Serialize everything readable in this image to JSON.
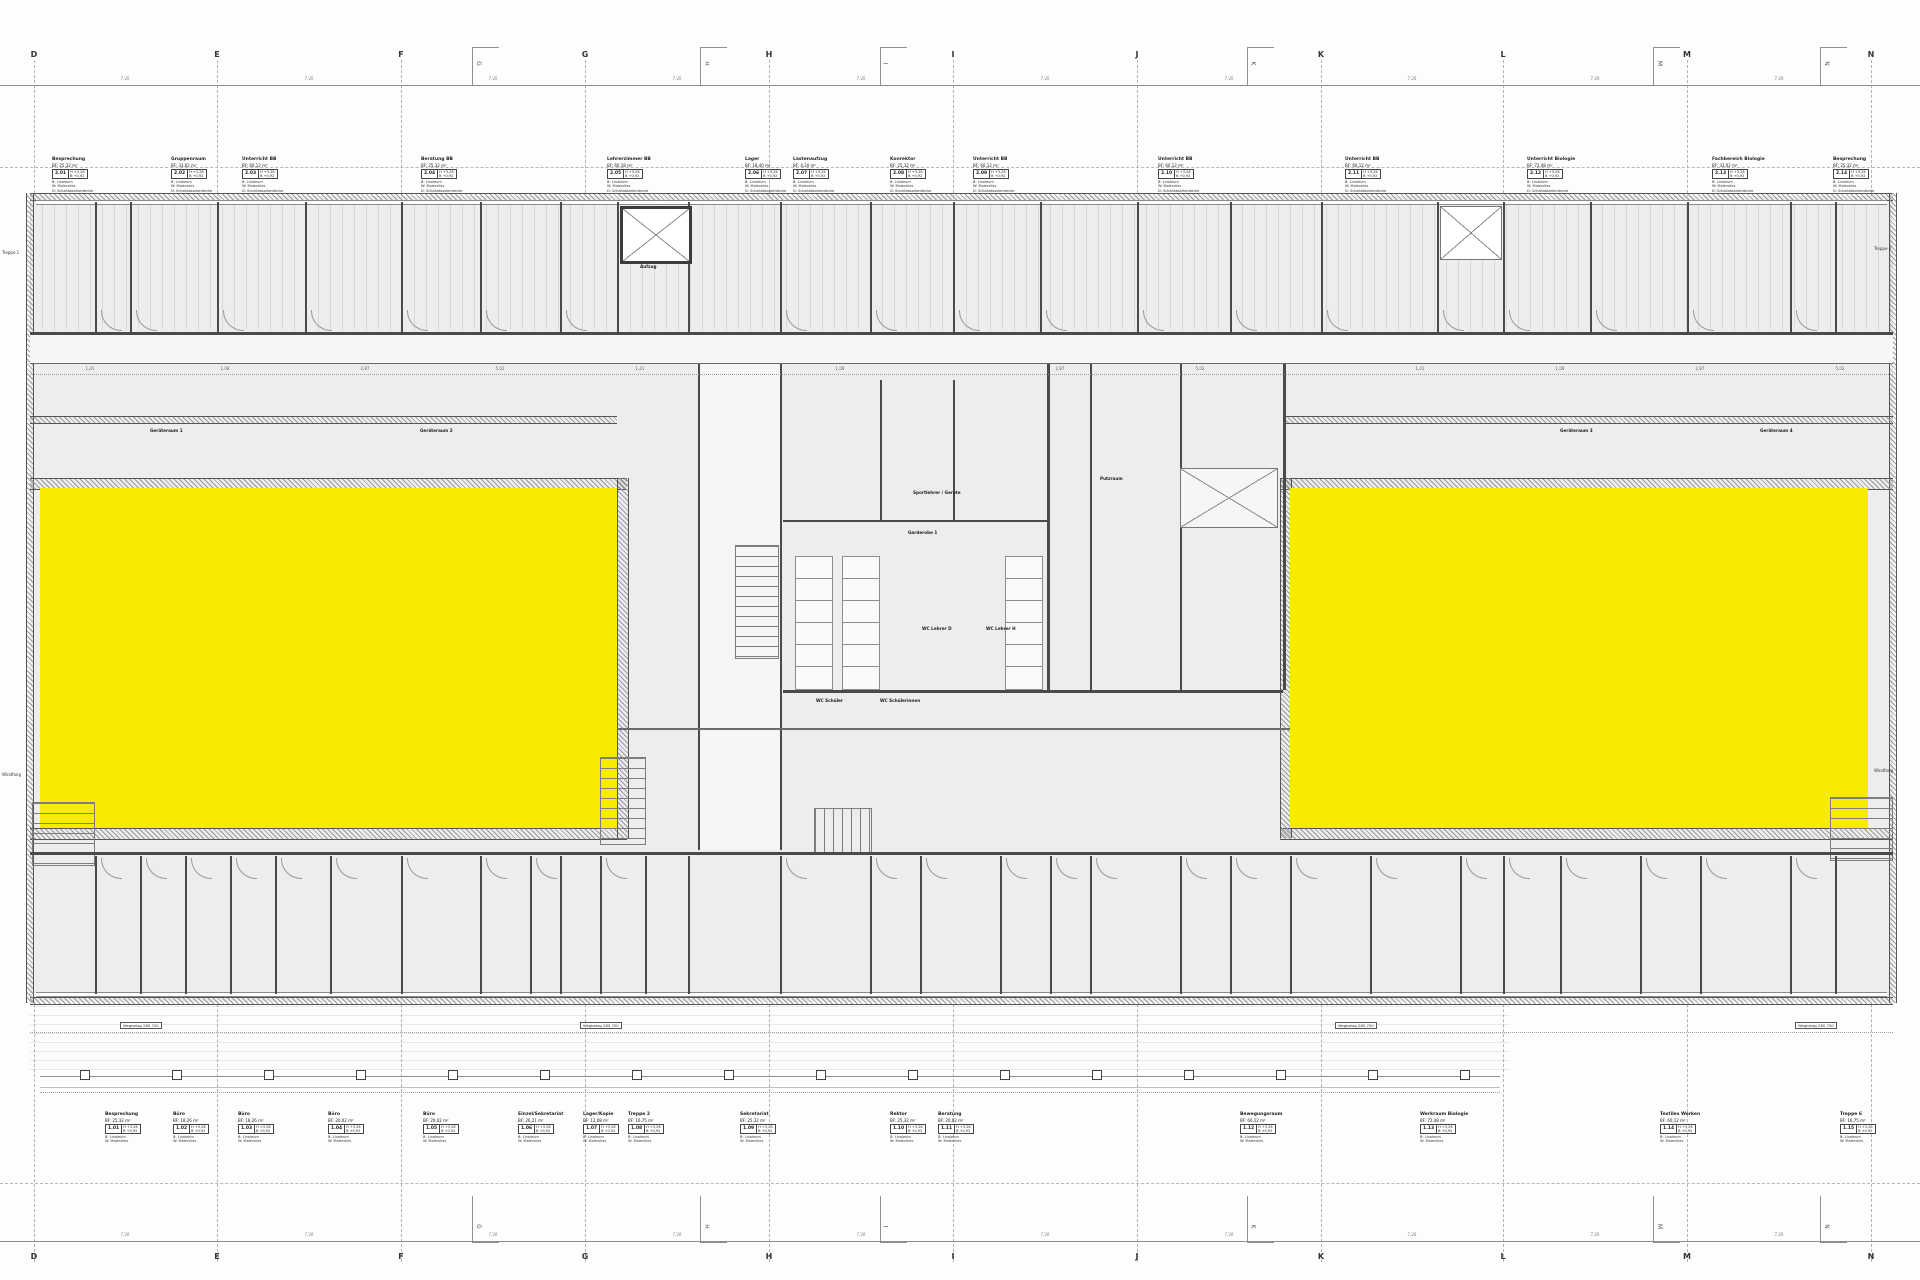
{
  "colors": {
    "highlight": "#F7EB00",
    "wall": "#4a4a4a",
    "grid_line": "#b3b3b3",
    "floor": "#ededed",
    "text": "#1a1a1a"
  },
  "grid": {
    "letters": [
      {
        "label": "D",
        "x": 34
      },
      {
        "label": "E",
        "x": 217
      },
      {
        "label": "F",
        "x": 401
      },
      {
        "label": "G",
        "x": 585
      },
      {
        "label": "H",
        "x": 769
      },
      {
        "label": "I",
        "x": 953
      },
      {
        "label": "J",
        "x": 1137
      },
      {
        "label": "K",
        "x": 1321
      },
      {
        "label": "L",
        "x": 1503
      },
      {
        "label": "M",
        "x": 1687
      },
      {
        "label": "N",
        "x": 1871
      }
    ]
  },
  "ruler": {
    "dims": [
      {
        "v": "7,20",
        "x": 125
      },
      {
        "v": "7,20",
        "x": 309
      },
      {
        "v": "7,20",
        "x": 493
      },
      {
        "v": "7,20",
        "x": 677
      },
      {
        "v": "7,20",
        "x": 861
      },
      {
        "v": "7,20",
        "x": 1045
      },
      {
        "v": "7,20",
        "x": 1229
      },
      {
        "v": "7,20",
        "x": 1412
      },
      {
        "v": "7,20",
        "x": 1595
      },
      {
        "v": "7,20",
        "x": 1779
      }
    ]
  },
  "brackets": [
    {
      "x": 472,
      "letter": "G"
    },
    {
      "x": 700,
      "letter": "H"
    },
    {
      "x": 880,
      "letter": "I"
    },
    {
      "x": 1247,
      "letter": "K"
    },
    {
      "x": 1653,
      "letter": "M"
    },
    {
      "x": 1820,
      "letter": "N"
    }
  ],
  "stamps_common": {
    "box_r1": "H +3,26",
    "box_r2": "B +0,92",
    "l1": "B: Linoleum",
    "l2": "W: Malervlies",
    "l3": "D: Schallabsorberdecke"
  },
  "stamps_top": [
    {
      "title": "Besprechung",
      "area": "BF: 25,32 m²",
      "code": "2.01",
      "x": 52
    },
    {
      "title": "Gruppenraum",
      "area": "BF: 33,02 m²",
      "code": "2.02",
      "x": 171
    },
    {
      "title": "Unterricht BB",
      "area": "BF: 60,12 m²",
      "code": "2.03",
      "x": 242
    },
    {
      "title": "Beratung BB",
      "area": "BF: 25,32 m²",
      "code": "2.04",
      "x": 421
    },
    {
      "title": "Lehrerzimmer BB",
      "area": "BF: 60,18 m²",
      "code": "2.05",
      "x": 607
    },
    {
      "title": "Lager",
      "area": "BF: 18,40 m²",
      "code": "2.06",
      "x": 745
    },
    {
      "title": "Lastenaufzug",
      "area": "BF: 4,20 m²",
      "code": "2.07",
      "x": 793
    },
    {
      "title": "Konrektor",
      "area": "BF: 25,32 m²",
      "code": "2.08",
      "x": 890
    },
    {
      "title": "Unterricht BB",
      "area": "BF: 60,12 m²",
      "code": "2.09",
      "x": 973
    },
    {
      "title": "Unterricht BB",
      "area": "BF: 60,12 m²",
      "code": "2.10",
      "x": 1158
    },
    {
      "title": "Unterricht BB",
      "area": "BF: 60,12 m²",
      "code": "2.11",
      "x": 1345
    },
    {
      "title": "Unterricht Biologie",
      "area": "BF: 72,48 m²",
      "code": "2.12",
      "x": 1527
    },
    {
      "title": "Fachbereich Biologie",
      "area": "BF: 33,02 m²",
      "code": "2.13",
      "x": 1712
    },
    {
      "title": "Besprechung",
      "area": "BF: 25,32 m²",
      "code": "2.14",
      "x": 1833
    }
  ],
  "stamps_bottom": [
    {
      "title": "Besprechung",
      "area": "BF: 25,32 m²",
      "code": "1.01",
      "x": 105
    },
    {
      "title": "Büro",
      "area": "BF: 18,26 m²",
      "code": "1.02",
      "x": 173
    },
    {
      "title": "Büro",
      "area": "BF: 18,26 m²",
      "code": "1.03",
      "x": 238
    },
    {
      "title": "Büro",
      "area": "BF: 20,02 m²",
      "code": "1.04",
      "x": 328
    },
    {
      "title": "Büro",
      "area": "BF: 20,02 m²",
      "code": "1.05",
      "x": 423
    },
    {
      "title": "Einzel/Sekretariat",
      "area": "BF: 26,21 m²",
      "code": "1.06",
      "x": 518
    },
    {
      "title": "Lager/Kopie",
      "area": "BF: 12,08 m²",
      "code": "1.07",
      "x": 583
    },
    {
      "title": "Treppe 2",
      "area": "BF: 16,75 m²",
      "code": "1.08",
      "x": 628
    },
    {
      "title": "Sekretariat",
      "area": "BF: 25,32 m²",
      "code": "1.09",
      "x": 740
    },
    {
      "title": "Rektor",
      "area": "BF: 25,32 m²",
      "code": "1.10",
      "x": 890
    },
    {
      "title": "Beratung",
      "area": "BF: 20,02 m²",
      "code": "1.11",
      "x": 938
    },
    {
      "title": "Bewegungsraum",
      "area": "BF: 60,12 m²",
      "code": "1.12",
      "x": 1240
    },
    {
      "title": "Werkraum Biologie",
      "area": "BF: 72,48 m²",
      "code": "1.13",
      "x": 1420
    },
    {
      "title": "Textiles Werken",
      "area": "BF: 60,12 m²",
      "code": "1.14",
      "x": 1660
    },
    {
      "title": "Treppe 6",
      "area": "BF: 16,75 m²",
      "code": "1.15",
      "x": 1840
    }
  ],
  "stamps_mid": [
    {
      "title": "Geräteraum 1",
      "x": 150,
      "y": 428
    },
    {
      "title": "Geräteraum 2",
      "x": 420,
      "y": 428
    },
    {
      "title": "Putzraum",
      "x": 1100,
      "y": 476
    },
    {
      "title": "Geräteraum 3",
      "x": 1560,
      "y": 428
    },
    {
      "title": "Geräteraum 4",
      "x": 1760,
      "y": 428
    },
    {
      "title": "Sportlehrer / Geräte",
      "x": 913,
      "y": 490
    },
    {
      "title": "Garderobe 1",
      "x": 908,
      "y": 530
    },
    {
      "title": "WC Lehrer D",
      "x": 922,
      "y": 626
    },
    {
      "title": "WC Lehrer H",
      "x": 986,
      "y": 626
    },
    {
      "title": "WC Schüler",
      "x": 816,
      "y": 698
    },
    {
      "title": "WC Schülerinnen",
      "x": 880,
      "y": 698
    },
    {
      "title": "Aufzug",
      "x": 640,
      "y": 264
    }
  ],
  "dims_row": [
    {
      "v": "1,41",
      "x": 90
    },
    {
      "v": "1,08",
      "x": 225
    },
    {
      "v": "2,87",
      "x": 365
    },
    {
      "v": "5,02",
      "x": 500
    },
    {
      "v": "1,41",
      "x": 640
    },
    {
      "v": "1,08",
      "x": 840
    },
    {
      "v": "2,87",
      "x": 1060
    },
    {
      "v": "5,02",
      "x": 1200
    },
    {
      "v": "1,41",
      "x": 1420
    },
    {
      "v": "1,08",
      "x": 1560
    },
    {
      "v": "2,87",
      "x": 1700
    },
    {
      "v": "5,02",
      "x": 1840
    }
  ],
  "wegbelag": [
    {
      "t": "Wegbelag 280 700",
      "x": 120,
      "y": 1022
    },
    {
      "t": "Wegbelag 280 700",
      "x": 580,
      "y": 1022
    },
    {
      "t": "Wegbelag 280 700",
      "x": 1335,
      "y": 1022
    },
    {
      "t": "Wegbelag 280 700",
      "x": 1795,
      "y": 1022
    }
  ],
  "edge_labels": [
    {
      "t": "Treppe 1",
      "x": 2,
      "y": 250
    },
    {
      "t": "Windfang",
      "x": 2,
      "y": 772
    },
    {
      "t": "Treppe 4",
      "x": 1874,
      "y": 246
    },
    {
      "t": "Windfang",
      "x": 1874,
      "y": 768
    }
  ],
  "plan_geometry": {
    "walls_top": [
      {
        "x": 95
      },
      {
        "x": 130
      },
      {
        "x": 217
      },
      {
        "x": 305
      },
      {
        "x": 401
      },
      {
        "x": 480
      },
      {
        "x": 560
      },
      {
        "x": 617
      },
      {
        "x": 688
      },
      {
        "x": 780
      },
      {
        "x": 870
      },
      {
        "x": 953
      },
      {
        "x": 1040
      },
      {
        "x": 1137
      },
      {
        "x": 1230
      },
      {
        "x": 1321
      },
      {
        "x": 1437
      },
      {
        "x": 1503
      },
      {
        "x": 1590
      },
      {
        "x": 1687
      },
      {
        "x": 1790
      },
      {
        "x": 1835
      }
    ],
    "walls_bottom": [
      {
        "x": 95
      },
      {
        "x": 140
      },
      {
        "x": 185
      },
      {
        "x": 230
      },
      {
        "x": 275
      },
      {
        "x": 330
      },
      {
        "x": 401
      },
      {
        "x": 480
      },
      {
        "x": 530
      },
      {
        "x": 560
      },
      {
        "x": 600
      },
      {
        "x": 645
      },
      {
        "x": 688
      },
      {
        "x": 780
      },
      {
        "x": 870
      },
      {
        "x": 920
      },
      {
        "x": 1000
      },
      {
        "x": 1050
      },
      {
        "x": 1090
      },
      {
        "x": 1180
      },
      {
        "x": 1230
      },
      {
        "x": 1290
      },
      {
        "x": 1370
      },
      {
        "x": 1460
      },
      {
        "x": 1503
      },
      {
        "x": 1560
      },
      {
        "x": 1640
      },
      {
        "x": 1700
      },
      {
        "x": 1790
      },
      {
        "x": 1835
      }
    ],
    "doors_top": [
      {
        "x": 101
      },
      {
        "x": 136
      },
      {
        "x": 223
      },
      {
        "x": 311
      },
      {
        "x": 407
      },
      {
        "x": 486
      },
      {
        "x": 566
      },
      {
        "x": 786
      },
      {
        "x": 876
      },
      {
        "x": 959
      },
      {
        "x": 1046
      },
      {
        "x": 1143
      },
      {
        "x": 1236
      },
      {
        "x": 1327
      },
      {
        "x": 1443
      },
      {
        "x": 1509
      },
      {
        "x": 1596
      },
      {
        "x": 1693
      },
      {
        "x": 1796
      }
    ],
    "doors_bottom": [
      {
        "x": 101
      },
      {
        "x": 146
      },
      {
        "x": 191
      },
      {
        "x": 236
      },
      {
        "x": 281
      },
      {
        "x": 336
      },
      {
        "x": 407
      },
      {
        "x": 486
      },
      {
        "x": 536
      },
      {
        "x": 606
      },
      {
        "x": 786
      },
      {
        "x": 876
      },
      {
        "x": 926
      },
      {
        "x": 1006
      },
      {
        "x": 1056
      },
      {
        "x": 1096
      },
      {
        "x": 1186
      },
      {
        "x": 1236
      },
      {
        "x": 1296
      },
      {
        "x": 1376
      },
      {
        "x": 1466
      },
      {
        "x": 1509
      },
      {
        "x": 1566
      },
      {
        "x": 1646
      },
      {
        "x": 1706
      },
      {
        "x": 1796
      }
    ],
    "columns": [
      {
        "x": 80
      },
      {
        "x": 172
      },
      {
        "x": 264
      },
      {
        "x": 356
      },
      {
        "x": 448
      },
      {
        "x": 540
      },
      {
        "x": 632
      },
      {
        "x": 724
      },
      {
        "x": 816
      },
      {
        "x": 908
      },
      {
        "x": 1000
      },
      {
        "x": 1092
      },
      {
        "x": 1184
      },
      {
        "x": 1276
      },
      {
        "x": 1368
      },
      {
        "x": 1460
      }
    ],
    "stalls": [
      {
        "x": 795,
        "y": 556
      },
      {
        "x": 795,
        "y": 578
      },
      {
        "x": 795,
        "y": 600
      },
      {
        "x": 795,
        "y": 622
      },
      {
        "x": 795,
        "y": 644
      },
      {
        "x": 795,
        "y": 666
      },
      {
        "x": 842,
        "y": 556
      },
      {
        "x": 842,
        "y": 578
      },
      {
        "x": 842,
        "y": 600
      },
      {
        "x": 842,
        "y": 622
      },
      {
        "x": 842,
        "y": 644
      },
      {
        "x": 842,
        "y": 666
      },
      {
        "x": 1005,
        "y": 556
      },
      {
        "x": 1005,
        "y": 578
      },
      {
        "x": 1005,
        "y": 600
      },
      {
        "x": 1005,
        "y": 622
      },
      {
        "x": 1005,
        "y": 644
      },
      {
        "x": 1005,
        "y": 666
      }
    ]
  }
}
